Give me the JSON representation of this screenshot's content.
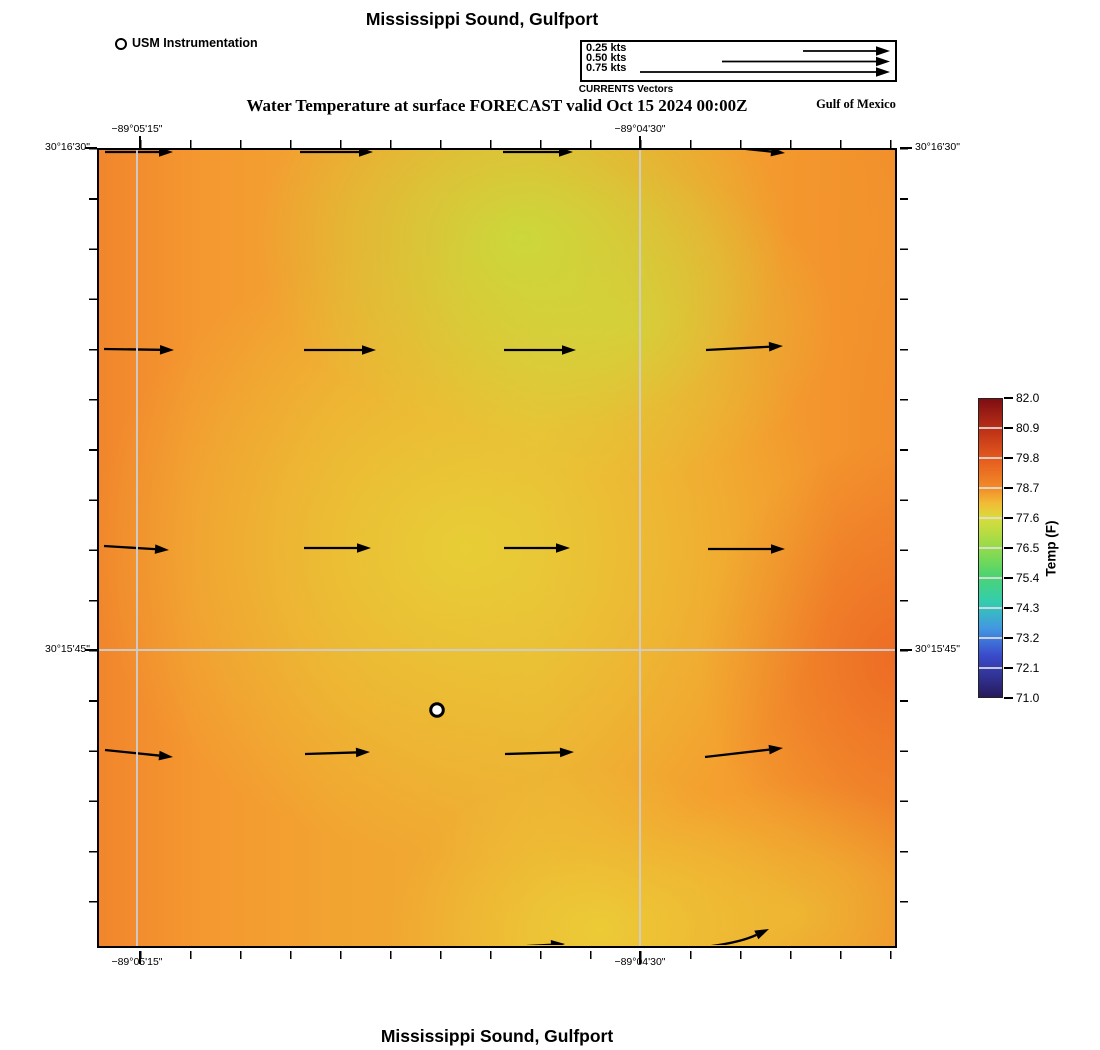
{
  "header": {
    "title_top": "Mississippi Sound, Gulfport",
    "subtitle": "Water Temperature at surface FORECAST valid Oct 15 2024 00:00Z",
    "station_legend": "USM Instrumentation",
    "region_label": "Gulf of Mexico"
  },
  "vector_legend": {
    "caption": "CURRENTS Vectors",
    "labels": [
      "0.25 kts",
      "0.50 kts",
      "0.75 kts"
    ],
    "arrows": [
      [
        221,
        9,
        308,
        9
      ],
      [
        140,
        19.5,
        308,
        19.5
      ],
      [
        58,
        30,
        308,
        30
      ]
    ]
  },
  "axes": {
    "x_labels": [
      "−89°05'15\"",
      "−89°04'30\""
    ],
    "y_labels": [
      "30°16'30\"",
      "30°15'45\""
    ]
  },
  "colorbar": {
    "label": "Temp (F)",
    "ticks": [
      "82.0",
      "80.9",
      "79.8",
      "78.7",
      "77.6",
      "76.5",
      "75.4",
      "74.3",
      "73.2",
      "72.1",
      "71.0"
    ],
    "min": 71.0,
    "max": 82.0
  },
  "footer": {
    "title_bottom": "Mississippi Sound, Gulfport"
  },
  "chart_data": {
    "type": "heatmap",
    "title": "Mississippi Sound, Gulfport",
    "subtitle": "Water Temperature at surface FORECAST valid Oct 15 2024 00:00Z",
    "variable": "Water Temperature at surface FORECAST",
    "valid": "Oct 15 2024 00:00Z",
    "xlabel_ticks": [
      "−89°05'15\"",
      "−89°04'30\""
    ],
    "ylabel_ticks": [
      "30°16'30\"",
      "30°15'45\""
    ],
    "colorbar": {
      "label": "Temp (F)",
      "min": 71.0,
      "max": 82.0,
      "tick_values": [
        82.0,
        80.9,
        79.8,
        78.7,
        77.6,
        76.5,
        75.4,
        74.3,
        73.2,
        72.1,
        71.0
      ]
    },
    "temperature_grid_F": {
      "note": "estimated from color field, 5 columns west→east by 5 rows north→south",
      "values": [
        [
          78.6,
          78.1,
          77.3,
          77.2,
          78.1
        ],
        [
          78.6,
          78.0,
          77.5,
          77.6,
          78.4
        ],
        [
          78.5,
          77.9,
          77.7,
          78.0,
          78.9
        ],
        [
          78.4,
          78.0,
          77.7,
          77.8,
          78.7
        ],
        [
          78.5,
          78.1,
          77.7,
          77.6,
          78.3
        ]
      ]
    },
    "vectors": {
      "direction": "E",
      "approx_speed_kts": 0.2,
      "reference_speeds_kts": [
        0.25,
        0.5,
        0.75
      ],
      "arrows": [
        [
          6,
          2,
          74,
          2
        ],
        [
          201,
          2,
          274,
          2
        ],
        [
          404,
          2,
          474,
          2
        ],
        [
          628,
          -3,
          686,
          3
        ],
        [
          5,
          199,
          75,
          200
        ],
        [
          205,
          200,
          277,
          200
        ],
        [
          405,
          200,
          477,
          200
        ],
        [
          607,
          200,
          684,
          196
        ],
        [
          5,
          396,
          70,
          400
        ],
        [
          205,
          398,
          272,
          398
        ],
        [
          405,
          398,
          471,
          398
        ],
        [
          609,
          399,
          686,
          399
        ],
        [
          6,
          600,
          74,
          607
        ],
        [
          206,
          604,
          271,
          602
        ],
        [
          406,
          604,
          475,
          602
        ],
        [
          606,
          607,
          684,
          598
        ],
        [
          428,
          796,
          466,
          794
        ]
      ],
      "curved_arrows": [
        [
          605,
          797,
          640,
          793,
          670,
          779
        ]
      ]
    },
    "station": {
      "name": "USM Instrumentation",
      "xy": [
        338,
        560
      ]
    }
  }
}
